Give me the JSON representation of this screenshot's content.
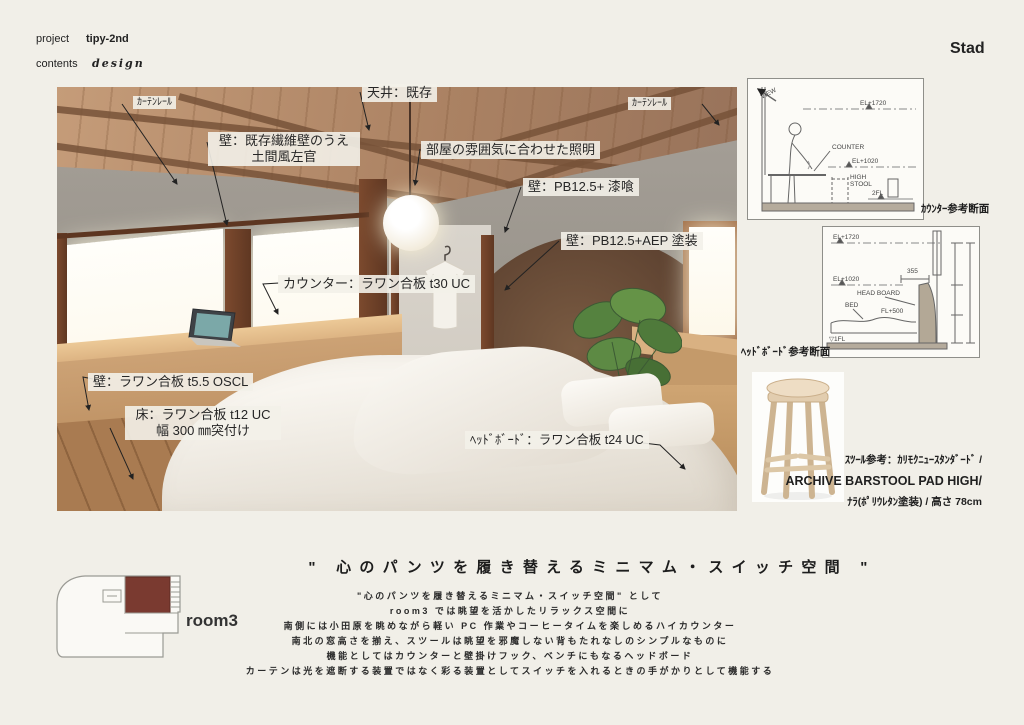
{
  "header": {
    "project_label": "project",
    "project_value": "tipy-2nd",
    "contents_label": "contents",
    "contents_value": "design",
    "brand": "Stad"
  },
  "render": {
    "annotations": {
      "curtain_rail_left": "ｶｰﾃﾝﾚｰﾙ",
      "ceiling": "天井：既存",
      "wall_fiber_line1": "壁：既存繊維壁のうえ",
      "wall_fiber_line2": "土間風左官",
      "lighting": "部屋の雰囲気に合わせた照明",
      "curtain_rail_right": "ｶｰﾃﾝﾚｰﾙ",
      "wall_pb_plaster": "壁：PB12.5+ 漆喰",
      "wall_pb_aep": "壁：PB12.5+AEP 塗装",
      "counter": "カウンター：ラワン合板 t30 UC",
      "wall_lauan": "壁：ラワン合板 t5.5 OSCL",
      "floor_line1": "床：ラワン合板 t12 UC",
      "floor_line2": "幅 300 ㎜突付け",
      "headboard": "ﾍｯﾄﾞﾎﾞｰﾄﾞ：ラワン合板 t24 UC"
    }
  },
  "counter_section": {
    "caption": "ｶｳﾝﾀｰ参考断面",
    "labels": {
      "view": "VIEW",
      "el_top": "EL+1720",
      "counter": "COUNTER",
      "el_mid": "EL+1020",
      "stool_1": "HIGH",
      "stool_2": "STOOL",
      "floor": "2FL"
    }
  },
  "headboard_section": {
    "caption": "ﾍｯﾄﾞﾎﾞｰﾄﾞ参考断面",
    "labels": {
      "el_top": "EL+1720",
      "el_mid": "EL+1020",
      "head_board": "HEAD BOARD",
      "bed": "BED",
      "fl500": "FL+500",
      "dim_355": "355",
      "dim_h700": "h=700",
      "dim_520": "520",
      "dim_500": "500",
      "dim_1720": "1720",
      "floor": "▽1FL"
    }
  },
  "stool": {
    "line1": "ｽﾂｰﾙ参考：ｶﾘﾓｸﾆｭｰｽﾀﾝﾀﾞｰﾄﾞ /",
    "line2": "ARCHIVE BARSTOOL PAD HIGH/",
    "line3": "ﾅﾗ(ﾎﾟﾘｳﾚﾀﾝ塗装) / 高さ 78cm"
  },
  "footer": {
    "title": "\" 心のパンツを履き替えるミニマム・スイッチ空間 \"",
    "description": [
      "\"心のパンツを履き替えるミニマム・スイッチ空間\" として",
      "room3 では眺望を活かしたリラックス空間に",
      "南側には小田原を眺めながら軽い PC 作業やコーヒータイムを楽しめるハイカウンター",
      "南北の窓高さを揃え、スツールは眺望を邪魔しない背もたれなしのシンプルなものに",
      "機能としてはカウンターと壁掛けフック、ベンチにもなるヘッドボード",
      "カーテンは光を遮断する装置ではなく彩る装置としてスイッチを入れるときの手がかりとして機能する"
    ],
    "plan_label": "room3"
  },
  "colors": {
    "page_bg": "#f1efe8",
    "plan_room_fill": "#7a3a30",
    "render_wood": "#ab8263",
    "render_gray_wall": "#9d9890"
  }
}
